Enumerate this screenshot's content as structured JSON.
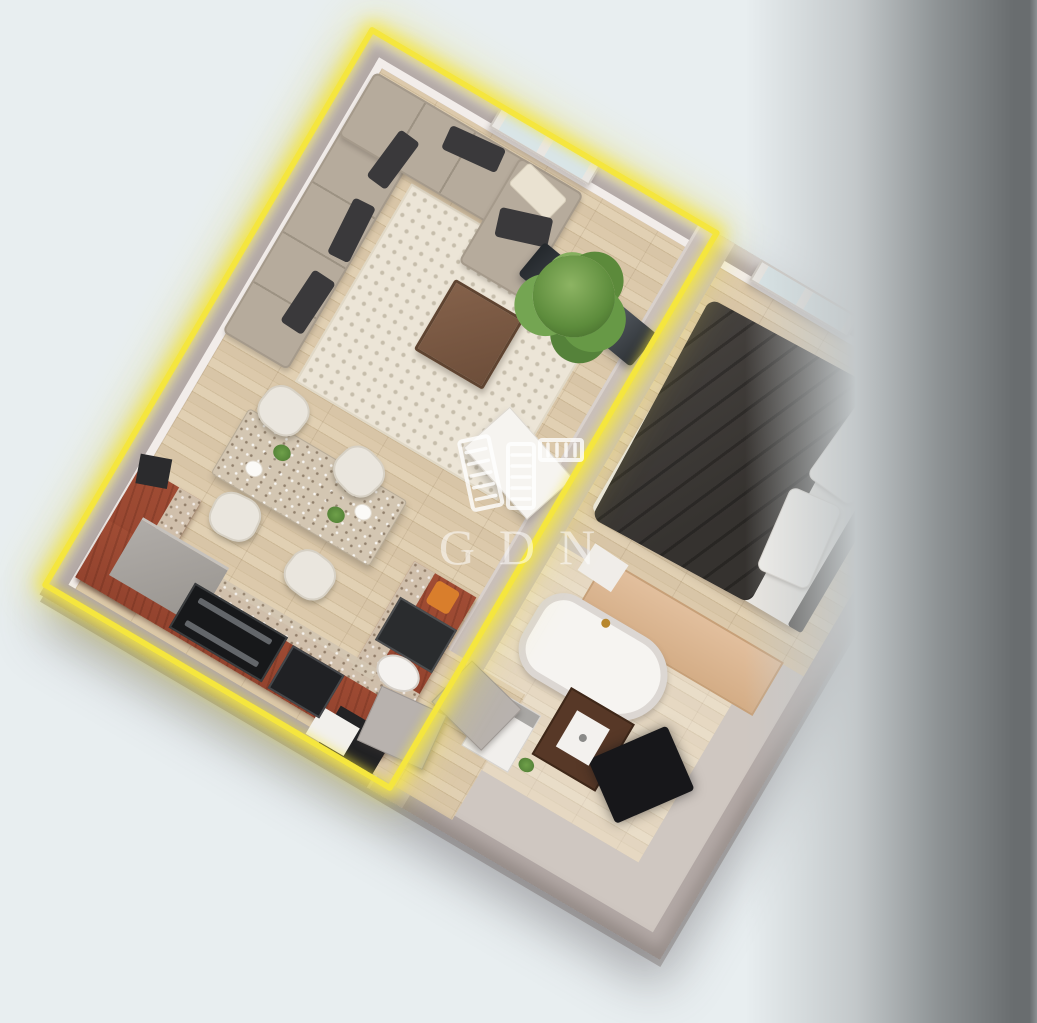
{
  "watermark": {
    "text": "GDN",
    "icon": "buildings-logo-icon"
  },
  "colors": {
    "background": "#e8eef0",
    "band-dark": "#696d6f",
    "highlight": "#f5e63e",
    "wall": "#b3a9a6",
    "wall-face": "#f2edea",
    "rug": "#ece5d7",
    "watermark-white": "rgba(255,255,255,0.58)"
  },
  "scene": {
    "type": "3d-floorplan-render",
    "highlighted_unit": "living-kitchen",
    "rooms": [
      "living-room",
      "dining-area",
      "kitchen",
      "bedroom",
      "bathroom",
      "hallway"
    ]
  }
}
